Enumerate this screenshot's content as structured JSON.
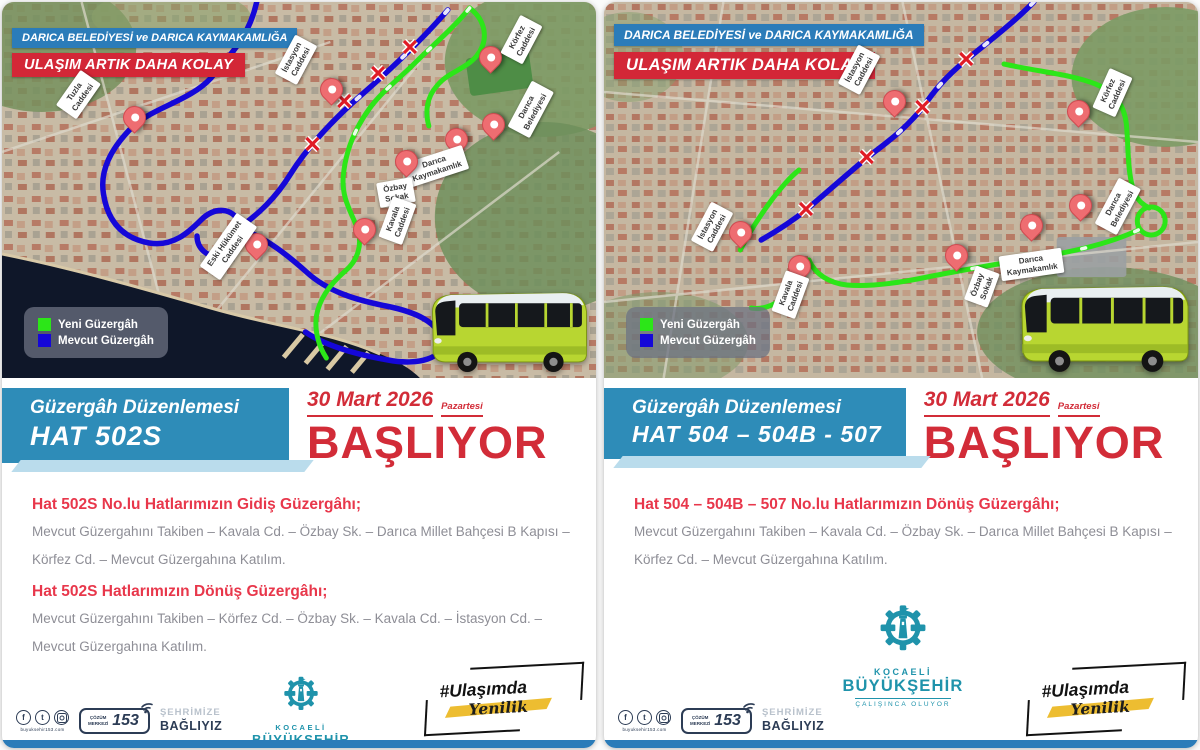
{
  "shared": {
    "header_line1": "DARICA BELEDİYESİ ve DARICA KAYMAKAMLIĞA",
    "header_line2": "ULAŞIM ARTIK DAHA KOLAY",
    "legend": {
      "new": "Yeni Güzergâh",
      "existing": "Mevcut Güzergâh"
    },
    "banner_title": "Güzergâh Düzenlemesi",
    "date": {
      "day": "30 Mart 2026",
      "weekday": "Pazartesi",
      "starting": "BAŞLIYOR"
    },
    "logo": {
      "name1": "KOCAELİ",
      "name2": "BÜYÜKŞEHİR",
      "tagline": "ÇALIŞINCA OLUYOR"
    },
    "footer": {
      "social_icons": [
        "facebook-icon",
        "twitter-icon",
        "instagram-icon"
      ],
      "url": "buyuksehir153.com",
      "call_small": "ÇÖZÜM\nMERKEZİ",
      "call_number": "153",
      "city_line1": "ŞEHRİMİZE",
      "city_line2": "BAĞLIYIZ",
      "hashtag1": "#Ulaşımda",
      "hashtag2": "Yenilik"
    },
    "colors": {
      "route_new": "#2ce618",
      "route_existing": "#1507d8",
      "header_blue": "#2b7cb9",
      "header_red": "#d32737",
      "banner_blue": "#2e8cb8",
      "heading_red": "#e8374b",
      "basliyor_red": "#d22c38",
      "logo_teal": "#1f93ab",
      "bus_green": "#b8d631",
      "navy": "#2c3c55",
      "yellow": "#edbd31"
    }
  },
  "left": {
    "route_code": "HAT 502S",
    "pins": [
      {
        "label": "Tuzla\nCaddesi"
      },
      {
        "label": "İstasyon\nCaddesi"
      },
      {
        "label": "Körfez\nCaddesi"
      },
      {
        "label": "Darıca\nBelediyesi"
      },
      {
        "label": "Darıca\nKaymakamlık"
      },
      {
        "label": "Özbay\nSokak"
      },
      {
        "label": "Kavala\nCaddesi"
      },
      {
        "label": "Eski Hükümet\nCaddesi"
      }
    ],
    "sections": [
      {
        "heading": "Hat 502S No.lu Hatlarımızın Gidiş Güzergâhı;",
        "body": "Mevcut Güzergahını Takiben – Kavala Cd. – Özbay Sk. – Darıca Millet Bahçesi B Kapısı – Körfez Cd. – Mevcut Güzergahına Katılım."
      },
      {
        "heading": "Hat 502S Hatlarımızın Dönüş Güzergâhı;",
        "body": "Mevcut Güzergahını Takiben – Körfez Cd. – Özbay Sk. – Kavala Cd. – İstasyon Cd. – Mevcut Güzergahına Katılım."
      }
    ]
  },
  "right": {
    "route_code": "HAT 504 – 504B - 507",
    "pins": [
      {
        "label": "İstasyon\nCaddesi"
      },
      {
        "label": "Körfez\nCaddesi"
      },
      {
        "label": "İstasyon\nCaddesi"
      },
      {
        "label": "Kavala\nCaddesi"
      },
      {
        "label": "Özbay\nSokak"
      },
      {
        "label": "Darıca\nKaymakamlık"
      },
      {
        "label": "Darıca\nBelediyesi"
      }
    ],
    "sections": [
      {
        "heading": "Hat 504 – 504B – 507  No.lu Hatlarımızın Dönüş Güzergâhı;",
        "body": "Mevcut Güzergahını Takiben – Kavala Cd. – Özbay Sk. – Darıca Millet Bahçesi B Kapısı – Körfez Cd. – Mevcut Güzergahına Katılım."
      }
    ]
  }
}
